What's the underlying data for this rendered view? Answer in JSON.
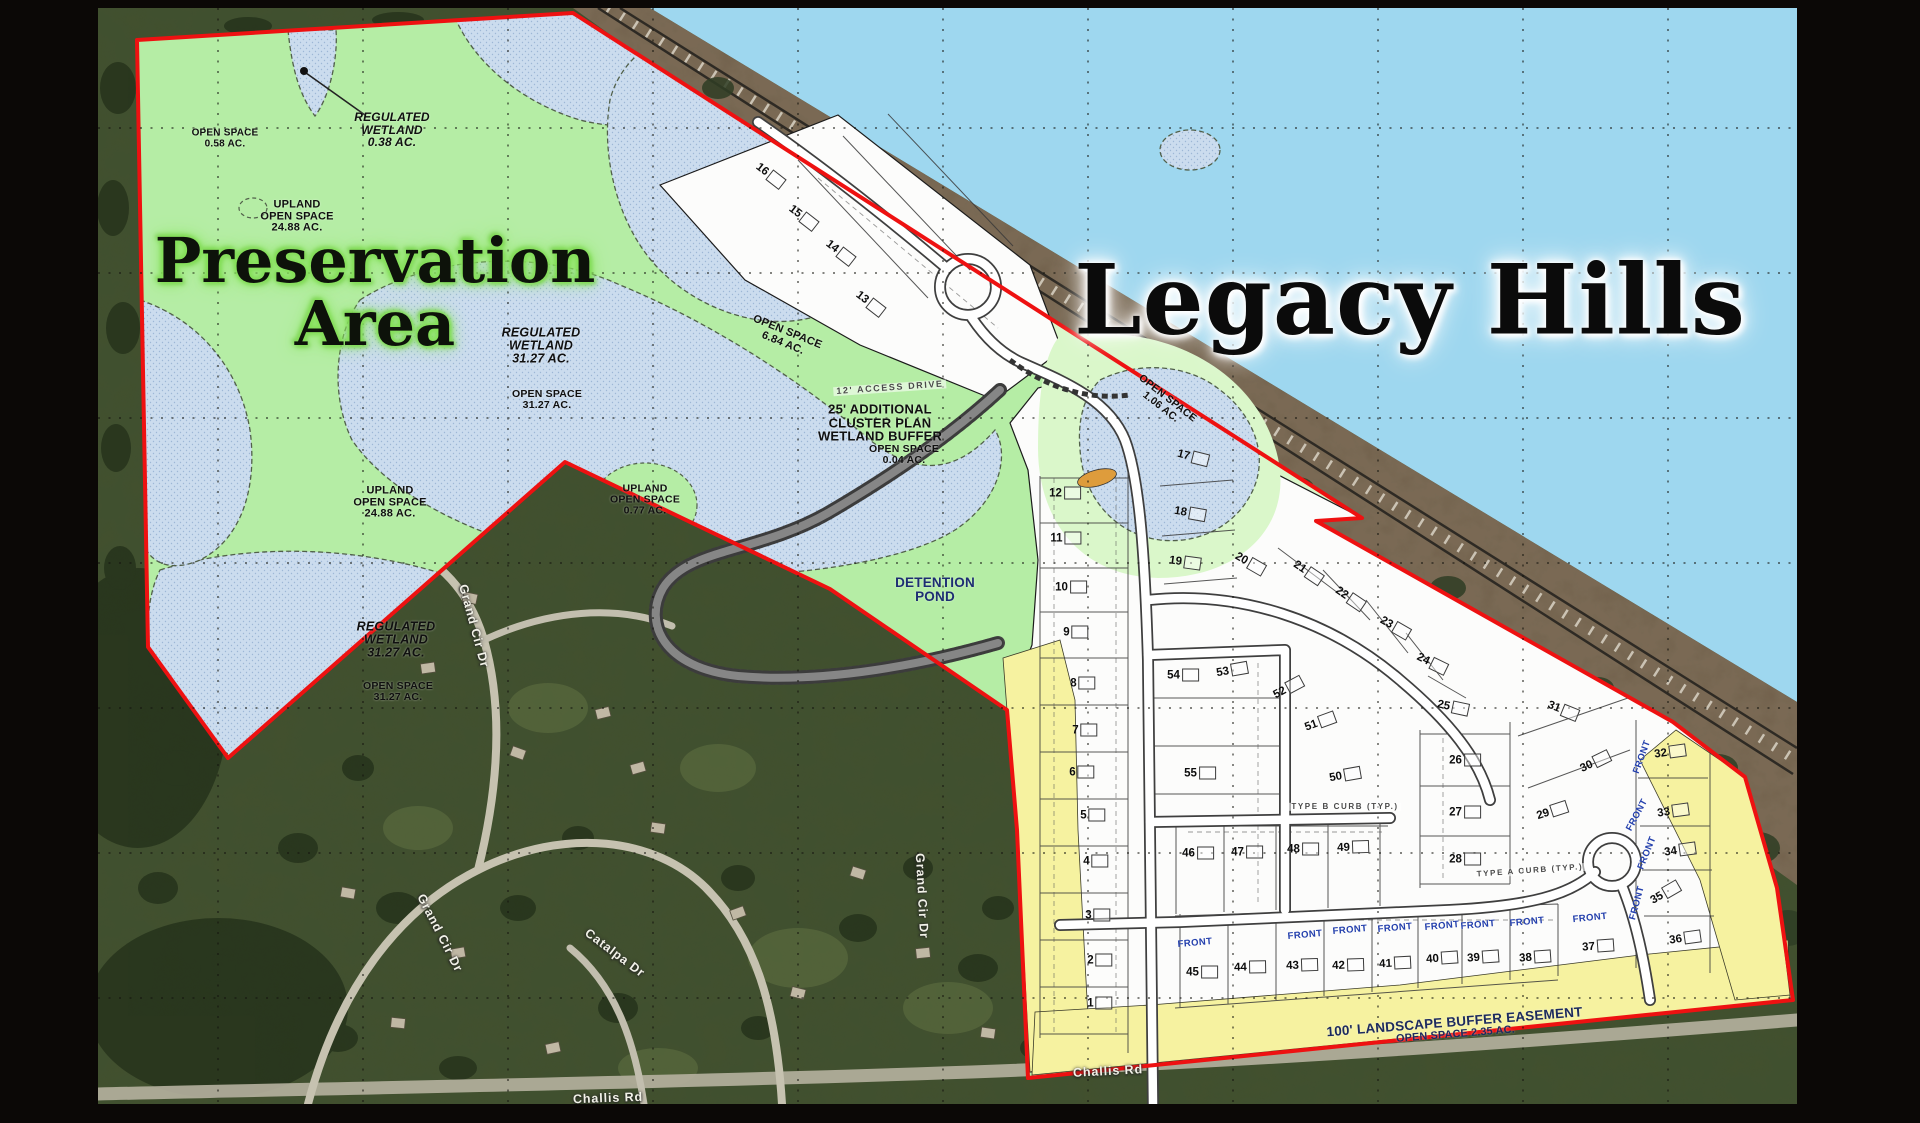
{
  "titles": {
    "main": "Legacy Hills",
    "preservation_line1": "Preservation",
    "preservation_line2": "Area"
  },
  "map_colors": {
    "boundary_red": "#ee1111",
    "preservation_green": "#b5eda5",
    "open_space_light_green": "#daf7ca",
    "wetland_blue": "#cbdcee",
    "water_blue": "#9ed7ef",
    "buffer_yellow": "#f6f2a0",
    "plan_white": "#fcfcfb"
  },
  "area_labels": [
    {
      "id": "open-space-0-58",
      "lines": [
        "OPEN SPACE",
        "0.58 AC."
      ],
      "x": 127,
      "y": 131,
      "fs": 10,
      "it": false,
      "rot": 0
    },
    {
      "id": "regulated-wetland-0-38",
      "lines": [
        "REGULATED",
        "WETLAND",
        "0.38 AC."
      ],
      "x": 294,
      "y": 122,
      "fs": 12,
      "it": true,
      "rot": 0
    },
    {
      "id": "upland-open-space-24-88-north",
      "lines": [
        "UPLAND",
        "OPEN SPACE",
        "24.88 AC."
      ],
      "x": 199,
      "y": 209,
      "fs": 11,
      "it": false,
      "rot": 0
    },
    {
      "id": "regulated-wetland-31-27-mid",
      "lines": [
        "REGULATED",
        "WETLAND",
        "31.27 AC."
      ],
      "x": 443,
      "y": 338,
      "fs": 12.5,
      "it": true,
      "rot": 0
    },
    {
      "id": "open-space-31-27-mid",
      "lines": [
        "OPEN SPACE",
        "31.27 AC."
      ],
      "x": 449,
      "y": 392,
      "fs": 10.5,
      "it": false,
      "rot": 0
    },
    {
      "id": "open-space-6-84",
      "lines": [
        "OPEN SPACE",
        "6.84 AC."
      ],
      "x": 687,
      "y": 330,
      "fs": 11,
      "it": false,
      "rot": 22
    },
    {
      "id": "access-drive-12ft",
      "lines": [
        "12' ACCESS DRIVE"
      ],
      "x": 792,
      "y": 380,
      "fs": 9,
      "it": false,
      "rot": -4,
      "muted": true
    },
    {
      "id": "cluster-wetland-buffer",
      "lines": [
        "25' ADDITIONAL",
        "CLUSTER PLAN",
        "WETLAND BUFFER"
      ],
      "x": 782,
      "y": 415,
      "fs": 13,
      "it": false,
      "rot": 0
    },
    {
      "id": "cluster-open-space-0-04",
      "lines": [
        "OPEN SPACE",
        "0.04 AC."
      ],
      "x": 806,
      "y": 447,
      "fs": 10.5,
      "it": false,
      "rot": 0
    },
    {
      "id": "upland-open-space-24-88-south",
      "lines": [
        "UPLAND",
        "OPEN SPACE",
        "24.88 AC."
      ],
      "x": 292,
      "y": 495,
      "fs": 11,
      "it": false,
      "rot": 0
    },
    {
      "id": "upland-open-space-0-77",
      "lines": [
        "UPLAND",
        "OPEN SPACE",
        "0.77 AC."
      ],
      "x": 547,
      "y": 492,
      "fs": 10.5,
      "it": false,
      "rot": 0
    },
    {
      "id": "detention-pond",
      "lines": [
        "DETENTION",
        "POND"
      ],
      "x": 837,
      "y": 582,
      "fs": 13.5,
      "it": false,
      "rot": 0,
      "color": "#1d2d72"
    },
    {
      "id": "regulated-wetland-31-27-south",
      "lines": [
        "REGULATED",
        "WETLAND",
        "31.27 AC."
      ],
      "x": 298,
      "y": 632,
      "fs": 12.5,
      "it": true,
      "rot": 0
    },
    {
      "id": "open-space-31-27-south",
      "lines": [
        "OPEN SPACE",
        "31.27 AC."
      ],
      "x": 300,
      "y": 684,
      "fs": 10.5,
      "it": false,
      "rot": 0
    },
    {
      "id": "open-space-1-06",
      "lines": [
        "OPEN SPACE",
        "1.06 AC."
      ],
      "x": 1066,
      "y": 395,
      "fs": 10.5,
      "it": false,
      "rot": 38
    },
    {
      "id": "landscape-buffer-easement",
      "lines": [
        "100' LANDSCAPE BUFFER EASEMENT",
        "OPEN SPACE 2.35 AC."
      ],
      "x": 1357,
      "y": 1020,
      "fs": 13.5,
      "it": false,
      "rot": -4.5,
      "color": "#1c2a5e",
      "shrink": true
    },
    {
      "id": "type-b-curb",
      "lines": [
        "TYPE B CURB (TYP.)"
      ],
      "x": 1247,
      "y": 799,
      "fs": 8,
      "it": false,
      "rot": 0,
      "muted": true
    },
    {
      "id": "type-a-curb",
      "lines": [
        "TYPE A CURB (TYP.)"
      ],
      "x": 1432,
      "y": 863,
      "fs": 8,
      "it": false,
      "rot": -4,
      "muted": true
    }
  ],
  "street_labels": [
    {
      "id": "grand-cir-dr-upper",
      "text": "Grand Cir Dr",
      "x": 376,
      "y": 618,
      "rot": 75
    },
    {
      "id": "grand-cir-dr-lower",
      "text": "Grand Cir Dr",
      "x": 342,
      "y": 925,
      "rot": 63
    },
    {
      "id": "grand-cir-dr-east",
      "text": "Grand Cir Dr",
      "x": 824,
      "y": 888,
      "rot": 87
    },
    {
      "id": "catalpa-dr",
      "text": "Catalpa Dr",
      "x": 517,
      "y": 945,
      "rot": 37
    },
    {
      "id": "challis-rd-west",
      "text": "Challis Rd",
      "x": 510,
      "y": 1090,
      "rot": -2
    },
    {
      "id": "challis-rd-east",
      "text": "Challis Rd",
      "x": 1010,
      "y": 1063,
      "rot": -3
    }
  ],
  "front_label": "FRONT",
  "front_positions": [
    {
      "x": 1097,
      "y": 935,
      "rot": -5
    },
    {
      "x": 1207,
      "y": 927,
      "rot": -5
    },
    {
      "x": 1252,
      "y": 922,
      "rot": -5
    },
    {
      "x": 1297,
      "y": 920,
      "rot": -5
    },
    {
      "x": 1344,
      "y": 918,
      "rot": -5
    },
    {
      "x": 1380,
      "y": 917,
      "rot": -5
    },
    {
      "x": 1429,
      "y": 914,
      "rot": -5
    },
    {
      "x": 1492,
      "y": 910,
      "rot": -6
    },
    {
      "x": 1544,
      "y": 749,
      "rot": -70
    },
    {
      "x": 1539,
      "y": 807,
      "rot": -62
    },
    {
      "x": 1549,
      "y": 845,
      "rot": -68
    },
    {
      "x": 1539,
      "y": 895,
      "rot": -75
    }
  ],
  "lots": [
    {
      "n": "1",
      "x": 1002,
      "y": 995,
      "r": 0
    },
    {
      "n": "2",
      "x": 1002,
      "y": 952,
      "r": 0
    },
    {
      "n": "3",
      "x": 1000,
      "y": 907,
      "r": 0
    },
    {
      "n": "4",
      "x": 998,
      "y": 853,
      "r": 0
    },
    {
      "n": "5",
      "x": 995,
      "y": 807,
      "r": 0
    },
    {
      "n": "6",
      "x": 984,
      "y": 764,
      "r": 0
    },
    {
      "n": "7",
      "x": 987,
      "y": 722,
      "r": 0
    },
    {
      "n": "8",
      "x": 985,
      "y": 675,
      "r": 0
    },
    {
      "n": "9",
      "x": 978,
      "y": 624,
      "r": 0
    },
    {
      "n": "10",
      "x": 973,
      "y": 579,
      "r": 0
    },
    {
      "n": "11",
      "x": 968,
      "y": 530,
      "r": 0
    },
    {
      "n": "12",
      "x": 967,
      "y": 485,
      "r": 0
    },
    {
      "n": "13",
      "x": 772,
      "y": 295,
      "r": 38
    },
    {
      "n": "14",
      "x": 742,
      "y": 244,
      "r": 38
    },
    {
      "n": "15",
      "x": 705,
      "y": 209,
      "r": 38
    },
    {
      "n": "16",
      "x": 672,
      "y": 167,
      "r": 38
    },
    {
      "n": "17",
      "x": 1095,
      "y": 449,
      "r": 14
    },
    {
      "n": "18",
      "x": 1092,
      "y": 505,
      "r": 10
    },
    {
      "n": "19",
      "x": 1087,
      "y": 554,
      "r": 8
    },
    {
      "n": "20",
      "x": 1152,
      "y": 555,
      "r": 30
    },
    {
      "n": "21",
      "x": 1210,
      "y": 564,
      "r": 34
    },
    {
      "n": "22",
      "x": 1252,
      "y": 590,
      "r": 34
    },
    {
      "n": "23",
      "x": 1297,
      "y": 619,
      "r": 30
    },
    {
      "n": "24",
      "x": 1334,
      "y": 655,
      "r": 26
    },
    {
      "n": "25",
      "x": 1355,
      "y": 699,
      "r": 12
    },
    {
      "n": "26",
      "x": 1367,
      "y": 752,
      "r": 0
    },
    {
      "n": "27",
      "x": 1367,
      "y": 804,
      "r": 0
    },
    {
      "n": "28",
      "x": 1367,
      "y": 851,
      "r": 0
    },
    {
      "n": "29",
      "x": 1454,
      "y": 803,
      "r": -18
    },
    {
      "n": "30",
      "x": 1497,
      "y": 754,
      "r": -26
    },
    {
      "n": "31",
      "x": 1465,
      "y": 702,
      "r": 22
    },
    {
      "n": "32",
      "x": 1572,
      "y": 744,
      "r": -8
    },
    {
      "n": "33",
      "x": 1575,
      "y": 803,
      "r": -8
    },
    {
      "n": "34",
      "x": 1582,
      "y": 842,
      "r": -8
    },
    {
      "n": "35",
      "x": 1567,
      "y": 885,
      "r": -30
    },
    {
      "n": "36",
      "x": 1587,
      "y": 930,
      "r": -8
    },
    {
      "n": "37",
      "x": 1500,
      "y": 938,
      "r": -4
    },
    {
      "n": "38",
      "x": 1437,
      "y": 949,
      "r": -4
    },
    {
      "n": "39",
      "x": 1385,
      "y": 949,
      "r": -4
    },
    {
      "n": "40",
      "x": 1344,
      "y": 950,
      "r": -4
    },
    {
      "n": "41",
      "x": 1297,
      "y": 955,
      "r": -3
    },
    {
      "n": "42",
      "x": 1250,
      "y": 957,
      "r": -2
    },
    {
      "n": "43",
      "x": 1204,
      "y": 957,
      "r": -2
    },
    {
      "n": "44",
      "x": 1152,
      "y": 959,
      "r": -1
    },
    {
      "n": "45",
      "x": 1104,
      "y": 964,
      "r": 0
    },
    {
      "n": "46",
      "x": 1100,
      "y": 845,
      "r": 0
    },
    {
      "n": "47",
      "x": 1149,
      "y": 844,
      "r": 0
    },
    {
      "n": "48",
      "x": 1205,
      "y": 841,
      "r": 0
    },
    {
      "n": "49",
      "x": 1255,
      "y": 839,
      "r": -2
    },
    {
      "n": "50",
      "x": 1247,
      "y": 767,
      "r": -10
    },
    {
      "n": "51",
      "x": 1222,
      "y": 714,
      "r": -20
    },
    {
      "n": "52",
      "x": 1190,
      "y": 680,
      "r": -28
    },
    {
      "n": "53",
      "x": 1134,
      "y": 662,
      "r": -10
    },
    {
      "n": "54",
      "x": 1085,
      "y": 667,
      "r": 0
    },
    {
      "n": "55",
      "x": 1102,
      "y": 765,
      "r": 0
    }
  ]
}
